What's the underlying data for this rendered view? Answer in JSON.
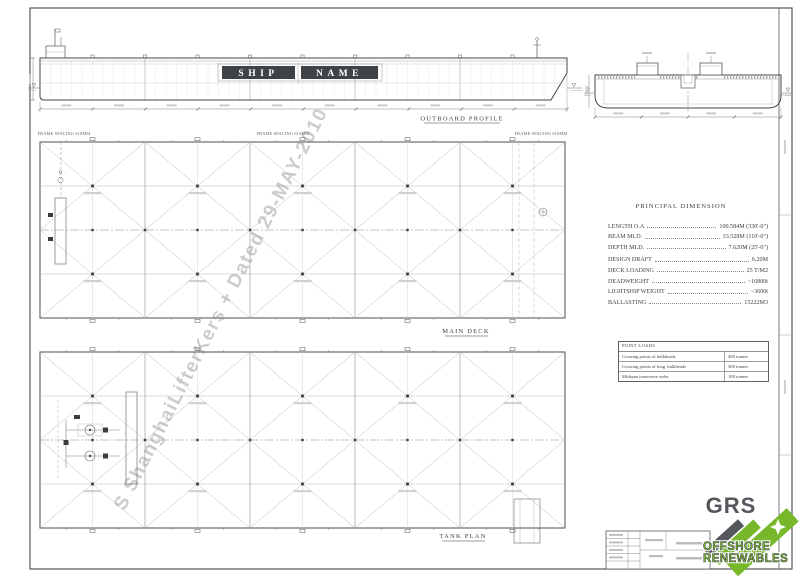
{
  "sheet": {
    "border_color": "#43464a"
  },
  "profile": {
    "ship_name_left": "SHIP",
    "ship_name_right": "NAME",
    "caption": "OUTBOARD PROFILE"
  },
  "deck_plan": {
    "caption": "MAIN DECK",
    "frame_spacing_labels": [
      "FRAME SPACING 610MM",
      "FRAME SPACING 610MM",
      "FRAME SPACING 610MM"
    ]
  },
  "tank_plan": {
    "caption": "TANK PLAN"
  },
  "principal_dimensions": {
    "title": "PRINCIPAL DIMENSION",
    "rows": [
      {
        "label": "LENGTH O.A",
        "value": "100.584M (330'-0\")"
      },
      {
        "label": "BEAM MLD.",
        "value": "33.528M (110'-0\")"
      },
      {
        "label": "DEPTH MLD.",
        "value": "7.620M (25'-0\")"
      },
      {
        "label": "DESIGN DRAFT",
        "value": "6.20M"
      },
      {
        "label": "DECK LOADING",
        "value": "25 T/M2"
      },
      {
        "label": "DEADWEIGHT",
        "value": "~16800t"
      },
      {
        "label": "LIGHTSHIP WEIGHT",
        "value": "~3600t"
      },
      {
        "label": "BALLASTING",
        "value": "15222M3"
      }
    ]
  },
  "point_loads": {
    "title": "POINT LOADS",
    "rows": [
      {
        "label": "Crossing points of bulkheads",
        "value": "400 tonnes"
      },
      {
        "label": "Crossing points of long. bulkheads",
        "value": "300 tonnes"
      },
      {
        "label": "Midspan transverse webs",
        "value": "100 tonnes"
      }
    ]
  },
  "watermark": {
    "text": "S ShanghaiLifterKers + Dated 29-MAY-2010"
  },
  "logo": {
    "line1": "GRS",
    "line2": "OFFSHORE",
    "line3": "RENEWABLES",
    "green": "#76b82a",
    "dark": "#54585c"
  }
}
